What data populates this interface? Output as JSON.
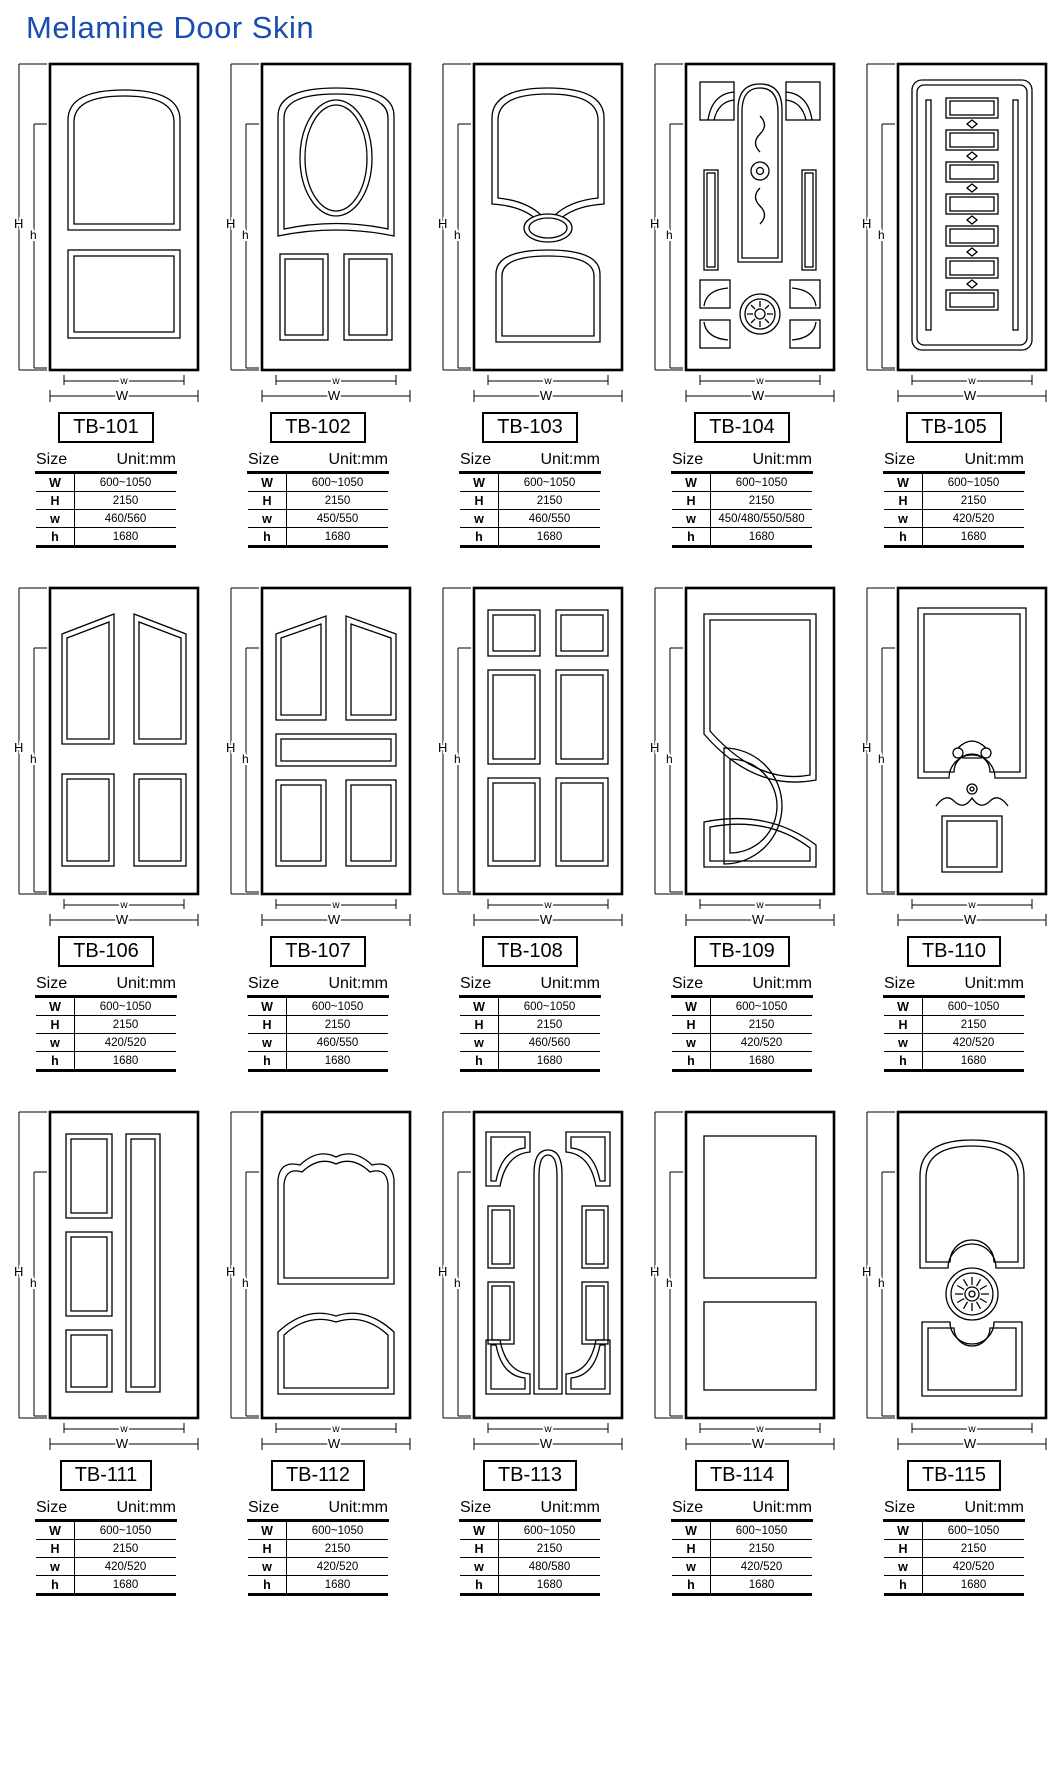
{
  "page": {
    "title": "Melamine Door Skin"
  },
  "colors": {
    "title_blue": "#1b4db0",
    "line": "#000000",
    "background": "#ffffff"
  },
  "dim_labels": {
    "outer_height": "H",
    "inner_height": "h",
    "outer_width": "W",
    "inner_width": "w"
  },
  "table": {
    "size_label": "Size",
    "unit_label": "Unit:mm",
    "row_labels": [
      "W",
      "H",
      "w",
      "h"
    ]
  },
  "doors": [
    {
      "model": "TB-101",
      "design_name": "arched-top-panel-over-square-panel",
      "W": "600~1050",
      "H": "2150",
      "w": "460/560",
      "h": "1680"
    },
    {
      "model": "TB-102",
      "design_name": "oval-in-panel-with-two-bottom-panels",
      "W": "600~1050",
      "H": "2150",
      "w": "450/550",
      "h": "1680"
    },
    {
      "model": "TB-103",
      "design_name": "arch-panel-small-oval-arch-bottom-panel",
      "W": "600~1050",
      "H": "2150",
      "w": "460/550",
      "h": "1680"
    },
    {
      "model": "TB-104",
      "design_name": "ornate-arch-scrollwork-with-medallion",
      "W": "600~1050",
      "H": "2150",
      "w": "450/480/550/580",
      "h": "1680"
    },
    {
      "model": "TB-105",
      "design_name": "stacked-block-column-with-side-rails",
      "W": "600~1050",
      "H": "2150",
      "w": "420/520",
      "h": "1680"
    },
    {
      "model": "TB-106",
      "design_name": "four-panel-slant-top",
      "W": "600~1050",
      "H": "2150",
      "w": "420/520",
      "h": "1680"
    },
    {
      "model": "TB-107",
      "design_name": "five-panel-slant-top-with-center-rail",
      "W": "600~1050",
      "H": "2150",
      "w": "460/550",
      "h": "1680"
    },
    {
      "model": "TB-108",
      "design_name": "six-panel",
      "W": "600~1050",
      "H": "2150",
      "w": "460/560",
      "h": "1680"
    },
    {
      "model": "TB-109",
      "design_name": "arc-divided-panels-with-half-circle",
      "W": "600~1050",
      "H": "2150",
      "w": "420/520",
      "h": "1680"
    },
    {
      "model": "TB-110",
      "design_name": "tall-arch-notch-panel-with-crest-and-square",
      "W": "600~1050",
      "H": "2150",
      "w": "420/520",
      "h": "1680"
    },
    {
      "model": "TB-111",
      "design_name": "three-stacked-panels-with-tall-side-panel",
      "W": "600~1050",
      "H": "2150",
      "w": "420/520",
      "h": "1680"
    },
    {
      "model": "TB-112",
      "design_name": "ogee-arch-panel-over-arch-panel",
      "W": "600~1050",
      "H": "2150",
      "w": "420/520",
      "h": "1680"
    },
    {
      "model": "TB-113",
      "design_name": "center-capsule-with-corner-fans-and-side-panels",
      "W": "600~1050",
      "H": "2150",
      "w": "480/580",
      "h": "1680"
    },
    {
      "model": "TB-114",
      "design_name": "two-flat-rect-panels",
      "W": "600~1050",
      "H": "2150",
      "w": "420/520",
      "h": "1680"
    },
    {
      "model": "TB-115",
      "design_name": "arch-panel-sunburst-medallion-lower-panel",
      "W": "600~1050",
      "H": "2150",
      "w": "420/520",
      "h": "1680"
    }
  ]
}
